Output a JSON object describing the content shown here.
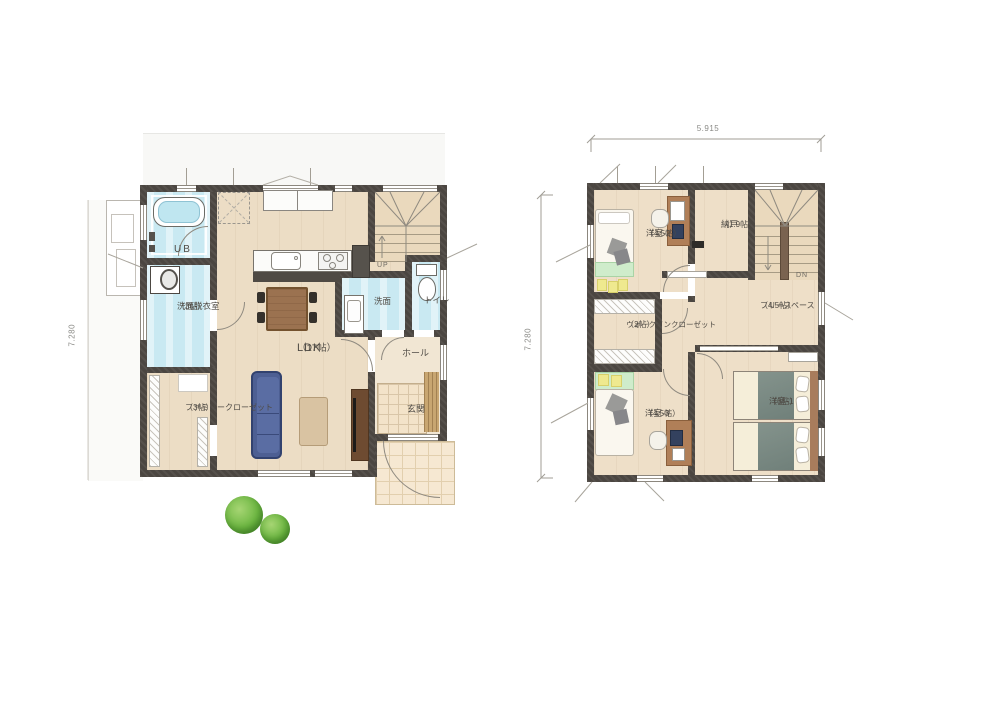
{
  "floor1": {
    "dimension_left": "7.280",
    "stairs_label": "UP",
    "rooms": {
      "ub": {
        "name": "UB"
      },
      "laundry": {
        "name": "洗面脱衣室",
        "size": "（3帖）"
      },
      "family_closet": {
        "name": "ファミリークローゼット",
        "size": "（3帖）"
      },
      "ldk": {
        "name": "LDK",
        "size": "（17帖）"
      },
      "washroom": {
        "name": "洗面"
      },
      "toilet": {
        "name": "トイレ"
      },
      "hall": {
        "name": "ホール"
      },
      "entrance": {
        "name": "玄関"
      }
    }
  },
  "floor2": {
    "dimension_top": "5.915",
    "dimension_left": "7.280",
    "stairs_label": "DN",
    "rooms": {
      "bedroom2": {
        "name": "洋室-2",
        "size": "（4.5帖）"
      },
      "storage": {
        "name": "納戸",
        "size": "（1.9帖）"
      },
      "free_space": {
        "name": "フリースペース",
        "size": "（4.5帖）"
      },
      "walk_in_closet": {
        "name": "ウォークインクローゼット",
        "size": "（2帖）"
      },
      "bedroom3": {
        "name": "洋室-3",
        "size": "（4.5帖）"
      },
      "bedroom1": {
        "name": "洋室-1",
        "size": "（6帖）"
      }
    }
  },
  "colors": {
    "wall": "#4b4641",
    "floor": "#ecddc5",
    "wet_room": "#c9e9f2",
    "bathtub": "#bfe6f0",
    "tile": "#f3e3c9",
    "sofa": "#4d5f93",
    "tree": "#6cb443",
    "bed_accent": "#cfeccb",
    "blanket": "#7d8c85",
    "wood_furniture": "#b07f58"
  }
}
